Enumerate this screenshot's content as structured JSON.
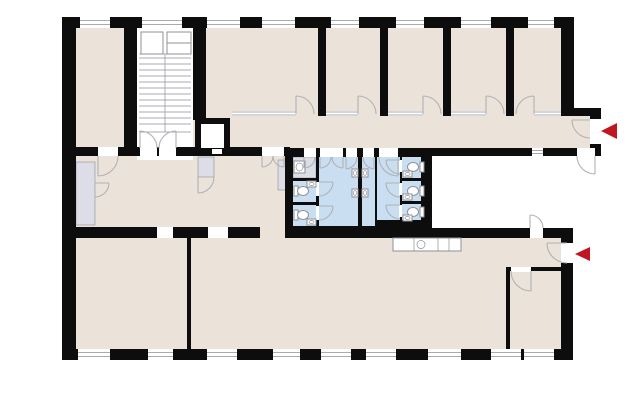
{
  "app": {
    "type": "architectural-floor-plan",
    "view": "2d-top-down"
  },
  "colors": {
    "bg": "#ffffff",
    "wall": "#0d0d0d",
    "room": "#ebe3d9",
    "wet": "#c9def1",
    "svc": "#dcdde6",
    "line": "#8e9096",
    "door": "#b0b2b6",
    "arrow": "#bf1622"
  },
  "features": {
    "staircase": "double-flight-stair",
    "elevator": "elevator-shaft",
    "corridor": "central-corridor",
    "sanitary_block": {
      "wc_stalls_left": 2,
      "wc_stalls_right": 3,
      "urinal_stalls": 2,
      "urinals": 4,
      "vestibules": 2,
      "fixtures": [
        "toilet",
        "washbasin",
        "urinal"
      ]
    },
    "kitchenette": "counter-with-sink",
    "courtyard": "recessed-light-well",
    "service_rooms": [
      "closet",
      "duct-shaft",
      "radiator"
    ],
    "windows_top": 8,
    "windows_bottom": 9
  },
  "entrance_markers": [
    {
      "name": "upper-entrance-arrow",
      "points": "left"
    },
    {
      "name": "lower-entrance-arrow",
      "points": "left"
    }
  ]
}
